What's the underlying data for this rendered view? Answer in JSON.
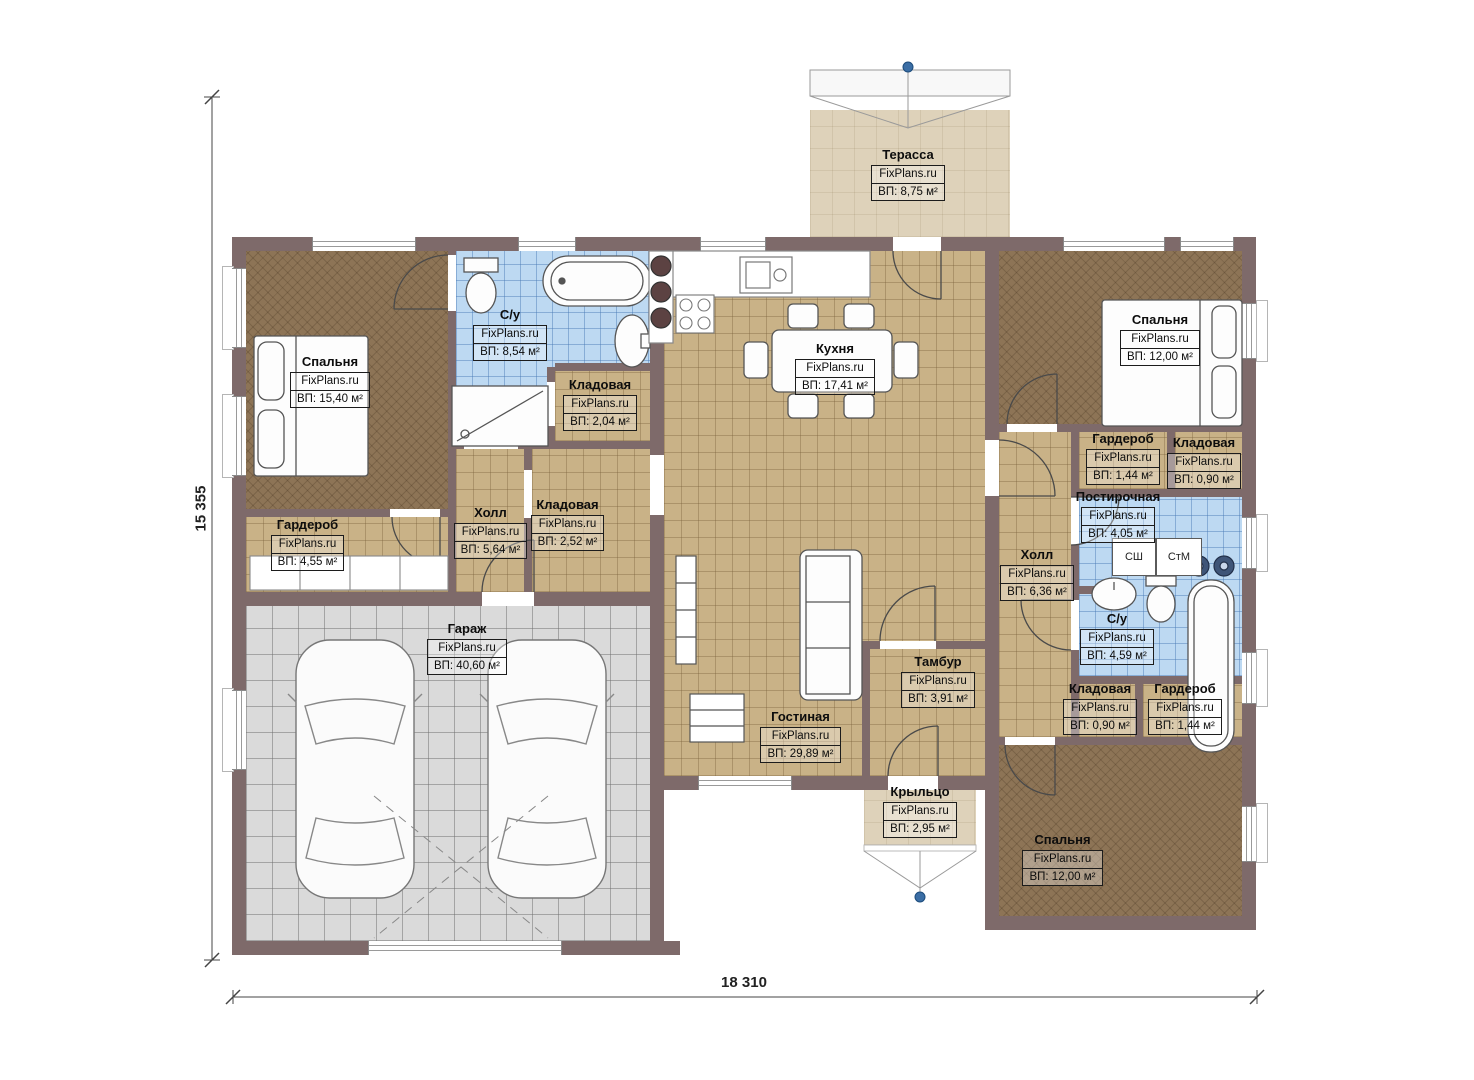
{
  "plan": {
    "brand": "FixPlans.ru",
    "dimensions": {
      "height_label": "15 355",
      "width_label": "18 310"
    },
    "appliances": {
      "dryer_label": "СШ",
      "washer_label": "СтМ"
    },
    "colors": {
      "wall": "#7e6a6a",
      "floor_bedroom": "#8d7456",
      "floor_common": "#c9b287",
      "floor_wet": "#bdd9f2",
      "floor_garage": "#dadada",
      "floor_outdoor": "#ded2ba",
      "marker_dot": "#3b6ea5"
    },
    "rooms": [
      {
        "name": "Терасса",
        "area": "ВП: 8,75 м²"
      },
      {
        "name": "Спальня",
        "area": "ВП: 15,40 м²"
      },
      {
        "name": "С/у",
        "area": "ВП: 8,54 м²"
      },
      {
        "name": "Кладовая",
        "area": "ВП: 2,04 м²"
      },
      {
        "name": "Кухня",
        "area": "ВП: 17,41 м²"
      },
      {
        "name": "Спальня",
        "area": "ВП: 12,00 м²"
      },
      {
        "name": "Гардероб",
        "area": "ВП: 4,55 м²"
      },
      {
        "name": "Холл",
        "area": "ВП: 5,64 м²"
      },
      {
        "name": "Кладовая",
        "area": "ВП: 2,52 м²"
      },
      {
        "name": "Гардероб",
        "area": "ВП: 1,44 м²"
      },
      {
        "name": "Кладовая",
        "area": "ВП: 0,90 м²"
      },
      {
        "name": "Постирочная",
        "area": "ВП: 4,05 м²"
      },
      {
        "name": "Холл",
        "area": "ВП: 6,36 м²"
      },
      {
        "name": "С/у",
        "area": "ВП: 4,59 м²"
      },
      {
        "name": "Гараж",
        "area": "ВП: 40,60 м²"
      },
      {
        "name": "Тамбур",
        "area": "ВП: 3,91 м²"
      },
      {
        "name": "Гостиная",
        "area": "ВП: 29,89 м²"
      },
      {
        "name": "Кладовая",
        "area": "ВП: 0,90 м²"
      },
      {
        "name": "Гардероб",
        "area": "ВП: 1,44 м²"
      },
      {
        "name": "Крыльцо",
        "area": "ВП: 2,95 м²"
      },
      {
        "name": "Спальня",
        "area": "ВП: 12,00 м²"
      }
    ]
  }
}
